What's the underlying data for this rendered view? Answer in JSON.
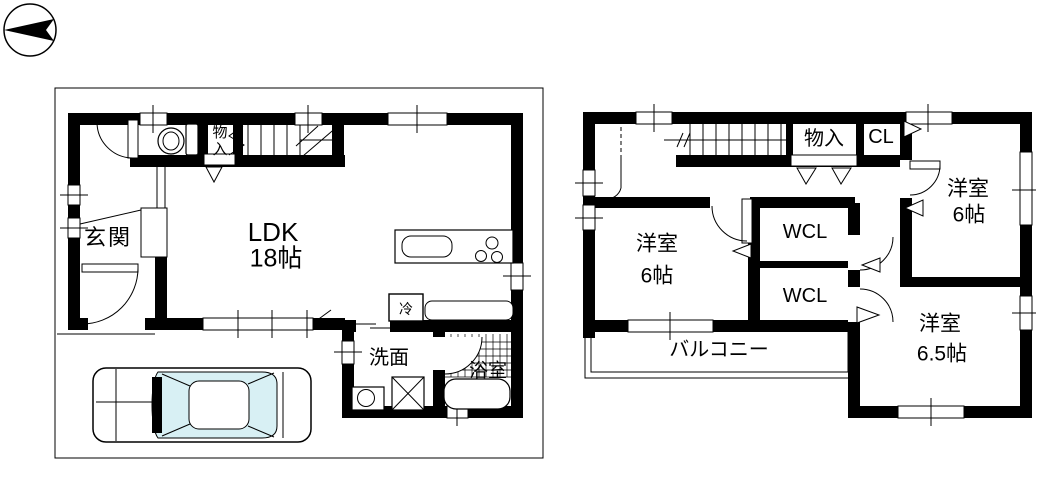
{
  "compass": {
    "icon": "north-arrow-icon",
    "points": "left"
  },
  "floor1": {
    "entrance": "玄関",
    "ldk_line1": "LDK",
    "ldk_line2": "18帖",
    "storage": "物入",
    "refrigerator": "冷",
    "washroom": "洗面",
    "bathroom": "浴室"
  },
  "floor2": {
    "storage": "物入",
    "closet": "CL",
    "bedroom_ne_line1": "洋室",
    "bedroom_ne_line2": "6帖",
    "wcl_upper": "WCL",
    "wcl_lower": "WCL",
    "bedroom_w_line1": "洋室",
    "bedroom_w_line2": "6帖",
    "bedroom_se_line1": "洋室",
    "bedroom_se_line2": "6.5帖",
    "balcony": "バルコニー"
  }
}
